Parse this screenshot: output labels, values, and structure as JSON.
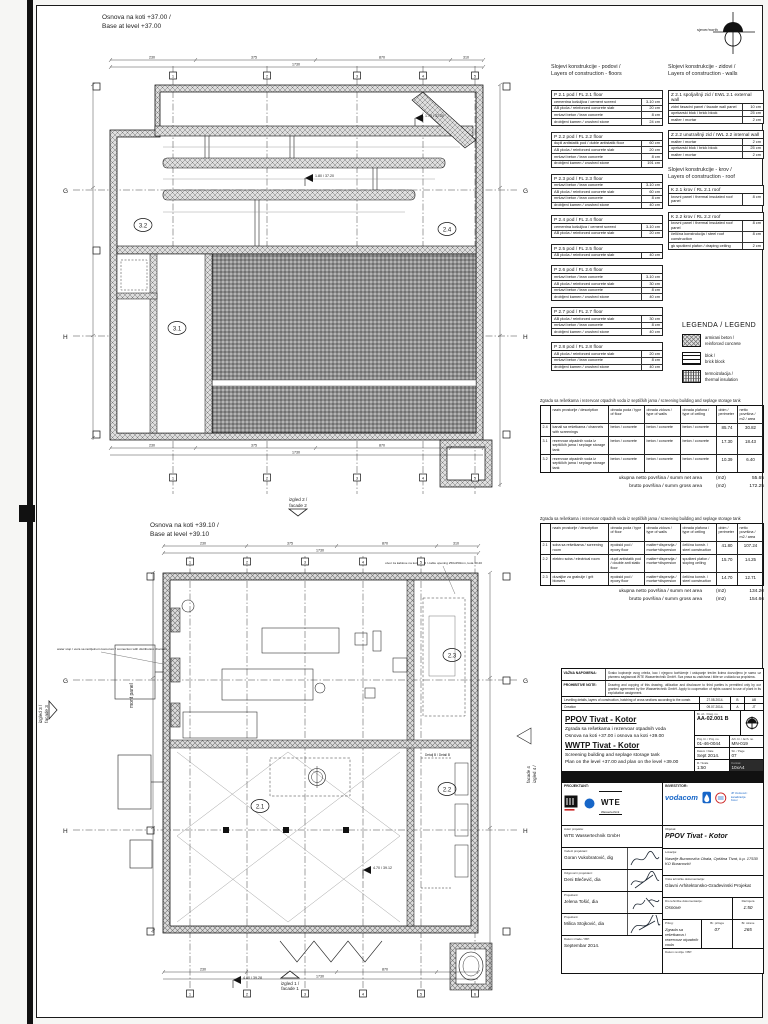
{
  "sheet": {
    "north_label": "sjever/north"
  },
  "plans": {
    "plan1": {
      "title_sr": "Osnova na koti +37.00 /",
      "title_en": "Base at level +37.00",
      "rooms": {
        "r32": "3.2",
        "r31": "3.1",
        "r24": "2.4"
      },
      "grid": {
        "g": "G",
        "h": "H"
      },
      "cols": [
        "1",
        "2",
        "3",
        "4",
        "5"
      ],
      "dims_top": [
        "230",
        "375",
        "870",
        "310"
      ],
      "dims_total": "1730",
      "elevs": [
        "1.80 / 37.20",
        "1.78 / 37.20"
      ]
    },
    "plan2": {
      "title_sr": "Osnova na koti +39.10 /",
      "title_en": "Base at level +39.10",
      "rooms": {
        "r21": "2.1",
        "r22": "2.2",
        "r23": "2.3"
      },
      "grid": {
        "g": "G",
        "h": "H"
      },
      "cols": [
        "1",
        "2",
        "3",
        "4",
        "5",
        "6"
      ],
      "dims_top": [
        "230",
        "375",
        "870",
        "310"
      ],
      "dims_total": "1730",
      "mont_panel": "mont panel",
      "detail_b": "Detalj B / Detail B",
      "ann_left1": "water stop / veza sa razdjelnom komorom / connection with distribution chamber",
      "ann_right": "otvor za kablove na koti 40.20 / cable opening 250x250mm, kota 40.20",
      "elevs": [
        "4.70 / 39.12",
        "4.80 / 39.28"
      ]
    }
  },
  "facades": {
    "f1a": "izgled 1 /",
    "f1b": "facade 1",
    "f2a": "izgled 2 /",
    "f2b": "facade 2",
    "f3a": "izgled 3 /",
    "f3b": "facade 3",
    "f4a": "izgled 4 /",
    "f4b": "facade 4"
  },
  "layers": {
    "floors_header1": "Slojevi konstrukcije - podovi /",
    "floors_header2": "Layers of construction - floors",
    "walls_header1": "Slojevi konstrukcije - zidovi /",
    "walls_header2": "Layers of construction - walls",
    "roof_header1": "Slojevi konstrukcije - krov /",
    "roof_header2": "Layers of construction - roof",
    "floor_tables": [
      {
        "title": "P 2.1 pod  /  FL 2.1 floor",
        "rows": [
          [
            "cementna košuljica / cement screed",
            "3-10 cm"
          ],
          [
            "AB ploča / reinforced concrete slab",
            "20 cm"
          ],
          [
            "mršavi beton / lean concrete",
            "8 cm"
          ],
          [
            "drobljeni kamen / crushed stone",
            "24 cm"
          ]
        ]
      },
      {
        "title": "P 2.2 pod  /  FL 2.2 floor",
        "rows": [
          [
            "dupli antistatik pod / duble antistatik floor",
            "60 cm"
          ],
          [
            "AB ploča / reinforced concrete slab",
            "20 cm"
          ],
          [
            "mršavi beton / lean concrete",
            "8 cm"
          ],
          [
            "drobljeni kamen / crushed stone",
            "191 cm"
          ]
        ]
      },
      {
        "title": "P 2.3 pod  /  FL 2.3 floor",
        "rows": [
          [
            "mršavi beton / lean concrete",
            "3-10 cm"
          ],
          [
            "AB ploča / reinforced concrete slab",
            "60 cm"
          ],
          [
            "mršavi beton / lean concrete",
            "8 cm"
          ],
          [
            "drobljeni kamen / crushed stone",
            "40 cm"
          ]
        ]
      },
      {
        "title": "P 2.4 pod  /  FL 2.4 floor",
        "rows": [
          [
            "cementna košuljica / cement screed",
            "3-10 cm"
          ],
          [
            "AB ploča / reinforced concrete slab",
            "20 cm"
          ]
        ]
      },
      {
        "title": "P 2.5 pod  /  FL 2.5 floor",
        "rows": [
          [
            "AB ploča / reinforced concrete slab",
            "40 cm"
          ]
        ]
      },
      {
        "title": "P 2.6 pod  /  FL 2.6 floor",
        "rows": [
          [
            "mršavi beton / lean concrete",
            "3-10 cm"
          ],
          [
            "AB ploča / reinforced concrete slab",
            "30 cm"
          ],
          [
            "mršavi beton / lean concrete",
            "8 cm"
          ],
          [
            "drobljeni kamen / crushed stone",
            "40 cm"
          ]
        ]
      },
      {
        "title": "P 2.7 pod  /  FL 2.7 floor",
        "rows": [
          [
            "AB ploča / reinforced concrete slab",
            "30 cm"
          ],
          [
            "mršavi beton / lean concrete",
            "8 cm"
          ],
          [
            "drobljeni kamen / crushed stone",
            "40 cm"
          ]
        ]
      },
      {
        "title": "P 2.8 pod  /  FL 2.8 floor",
        "rows": [
          [
            "AB ploča / reinforced concrete slab",
            "20 cm"
          ],
          [
            "mršavi beton / lean concrete",
            "8 cm"
          ],
          [
            "drobljeni kamen / crushed stone",
            "40 cm"
          ]
        ]
      }
    ],
    "wall_tables": [
      {
        "title": "Z 2.1 spoljašnji zid  /  EWL 2.1 external wall",
        "rows": [
          [
            "zidni fasadni panel / facade wall panel",
            "10 cm"
          ],
          [
            "opekarski blok / brick block",
            "25 cm"
          ],
          [
            "malter / mortar",
            "2 cm"
          ]
        ]
      },
      {
        "title": "Z 2.2 unutrašnji zid  /  IWL 2.2 internal wall",
        "rows": [
          [
            "malter / mortar",
            "2 cm"
          ],
          [
            "opekarski blok / brick block",
            "25 cm"
          ],
          [
            "malter / mortar",
            "2 cm"
          ]
        ]
      }
    ],
    "roof_tables": [
      {
        "title": "K 2.1 krov  /  RL 2.1 roof",
        "rows": [
          [
            "krovni panel / thermal insulated roof panel",
            "8 cm"
          ]
        ]
      },
      {
        "title": "K 2.2 krov  /  RL 2.2 roof",
        "rows": [
          [
            "krovni panel / thermal insulated roof panel",
            "8 cm"
          ],
          [
            "čelična konstrukcija / steel roof construction",
            "8 cm"
          ],
          [
            "gk spušteni plafon / draping ceiling",
            "2 cm"
          ]
        ]
      }
    ]
  },
  "legend": {
    "title": "LEGENDA / LEGEND",
    "items": [
      {
        "label1": "armirani beton /",
        "label2": "reinforced concrete"
      },
      {
        "label1": "blok /",
        "label2": "brick block"
      },
      {
        "label1": "termoizolacija /",
        "label2": "thermal insulation"
      }
    ]
  },
  "area_tables": [
    {
      "caption": "Zgrada sa rešetkama i rezervoar otpadnih voda iz septičkih jama / screening building and seplage storage tank",
      "headers": [
        "naziv prostorije / description",
        "obrada poda / type of floor",
        "obrada zidova / type of walls",
        "obrada plafona / type of ceiling",
        "obim / perimeter",
        "netto površina / m2 / area"
      ],
      "rows": [
        {
          "no": "2.4",
          "name": "kanali sa rešetkama / channels with screenings",
          "floor": "beton / concrete",
          "walls": "beton / concrete",
          "ceiling": "beton / concrete",
          "perimeter": "85.74",
          "area": "30.82"
        },
        {
          "no": "3.1",
          "name": "rezervoar otpadnih voda iz septičkih jama / seplage storage tank",
          "floor": "beton / concrete",
          "walls": "beton / concrete",
          "ceiling": "beton / concrete",
          "perimeter": "17.30",
          "area": "18.43"
        },
        {
          "no": "3.2",
          "name": "rezervoar otpadnih voda iz septičkih jama / seplage storage tank",
          "floor": "beton / concrete",
          "walls": "beton / concrete",
          "ceiling": "beton / concrete",
          "perimeter": "10.39",
          "area": "6.40"
        }
      ],
      "totals": [
        {
          "label": "ukupna netto površina / summ net area",
          "unit": "(m2)",
          "value": "55.65"
        },
        {
          "label": "brutto površina / summ gross area",
          "unit": "(m2)",
          "value": "172.25"
        }
      ]
    },
    {
      "caption": "Zgrada sa rešetkama i rezervoar otpadnih voda iz septičkih jama / screening building and seplage storage tank",
      "headers": [
        "naziv prostorije / description",
        "obrada poda / type of floor",
        "obrada zidova / type of walls",
        "obrada plafona / type of ceiling",
        "obim / perimeter",
        "netto površina / m2 / area"
      ],
      "rows": [
        {
          "no": "2.1",
          "name": "soba sa rešetkama / screening room",
          "floor": "epoksid pod / epoxy floor",
          "walls": "malter+disperzija / mortar+dispersion",
          "ceiling": "čelična konstr. / steel construction",
          "perimeter": "41.80",
          "area": "107.24"
        },
        {
          "no": "2.2",
          "name": "elektro soba / electrical room",
          "floor": "dupli antistatik pod / double anti static floor",
          "walls": "malter+disperzija / mortar+dispersion",
          "ceiling": "spušteni plafon / sloping ceiling",
          "perimeter": "15.70",
          "area": "14.25"
        },
        {
          "no": "2.3",
          "name": "duvaljke za grabulje / grit blowers",
          "floor": "epoksid pod / epoxy floor",
          "walls": "malter+disperzija / mortar+dispersion",
          "ceiling": "čelična konstr. / steel construction",
          "perimeter": "14.70",
          "area": "12.71"
        }
      ],
      "totals": [
        {
          "label": "ukupna netto površina / summ net area",
          "unit": "(m2)",
          "value": "134.20"
        },
        {
          "label": "brutto površina / summ gross area",
          "unit": "(m2)",
          "value": "154.66"
        }
      ]
    }
  ],
  "notes": [
    {
      "label": "VAŽNA NAPOMENA:",
      "text": "Svako kopiranje ovog crteža, kao i njegovo korišćenje i ustupanje trećim licima dozvoljeno je samo uz pismenu saglasnost WTE Wassertechnik GmbH. Sva prava su zadržana i štite se u skladu sa propisima."
    },
    {
      "label": "PROHIBITIVE NOTE:",
      "text": "Drawing and copying of this drawing, utilization and disclosure to third parties is permitted only by our granted agreement by the Wassertechnik GmbH. Apply to cooperation of rights caused to use of plant in its exploitation assignment."
    }
  ],
  "revisions": [
    {
      "desc": "Levelling details, layers of construction, hatching of cross sections according to the constr.",
      "date": "27.08.2014.",
      "rev": "B",
      "by": "AB"
    },
    {
      "desc": "Creation",
      "date": "09.07.2014.",
      "rev": "A",
      "by": "JT"
    }
  ],
  "titleblock": {
    "project_sr": "PPOV Tivat - Kotor",
    "subtitle_sr1": "Zgrada sa rešetkama i rezervoar otpadnih voda",
    "subtitle_sr2": "Osnova na koti +37.00 i osnova na koti +39.00",
    "project_en": "WWTP Tivat - Kotor",
    "subtitle_en1": "Screening building and seplage storage tank",
    "subtitle_en2": "Plan on the level +37.00 and plan on the level +39.00",
    "dwg_label": "Br. crt. / Dwg. no.",
    "dwg_no": "AA-02.001 B",
    "proj_label": "Proj. br. / Proj. no.",
    "proj_no": "01-46-0044",
    "arch_label": "Arh. br. / Arch. no.",
    "arch_no": "MN-019",
    "date_label": "Datum / Date",
    "date": "Sept 2014.",
    "page_label": "Str. / Page",
    "page": "07",
    "scale_label": "R / Scale",
    "scale": "1:50",
    "format_label": "Format",
    "format": "10xA4"
  },
  "signblock": {
    "left_header": "PROJEKTANT:",
    "right_header": "INVESTITOR:",
    "wte": "WTE",
    "wte_sub": "Wassertechnik",
    "vodacom": "vodacom",
    "vik1": "JP Vodovod i kanalizacija",
    "vik2": "Kotor",
    "fields_left": [
      {
        "label": "Autor projekta:",
        "value": "WTE Wassertechnik GmbH",
        "sig": 0
      },
      {
        "label": "Vodeći projektant:",
        "value": "Goran Vukobratović, dig",
        "sig": 1
      },
      {
        "label": "Odgovorni projektant:",
        "value": "Deni Blečević, dia",
        "sig": 2
      },
      {
        "label": "Projektant:",
        "value": "Jelena Tošić, dia",
        "sig": 3
      },
      {
        "label": "Projektant:",
        "value": "Milica Stojković, dia",
        "sig": 4
      },
      {
        "label": "Datum izrade / IBP:",
        "value": "Septembar 2014.",
        "sig": 0
      }
    ],
    "obj_label": "Objekat:",
    "obj_value": "PPOV Tivat - Kotor",
    "lok_label": "Lokacija:",
    "lok_value": "Naselje Buranovića Obala, Opština Tivat, k.p. 17530 KO Buranovići",
    "vrsta_label": "Vrsta tehničke dokumentacije:",
    "vrsta_value": "Glavni Arhitektonsko-Građevinski Projekat",
    "dio_label": "Dio tehničke dokumentacije:",
    "dio_value": "Osnove",
    "razmjera_label": "Razmjera",
    "razmjera_value": "1:50",
    "prilog_label": "Prilog:",
    "prilog_value": "Zgrada sa rešetkama i rezervoar otpadnih voda",
    "br_priloga_label": "Br. priloga",
    "br_priloga": "07",
    "br_strane_label": "Br. strane",
    "br_strane": "265",
    "datum_rev_label": "Datum revizije / IBP:"
  }
}
